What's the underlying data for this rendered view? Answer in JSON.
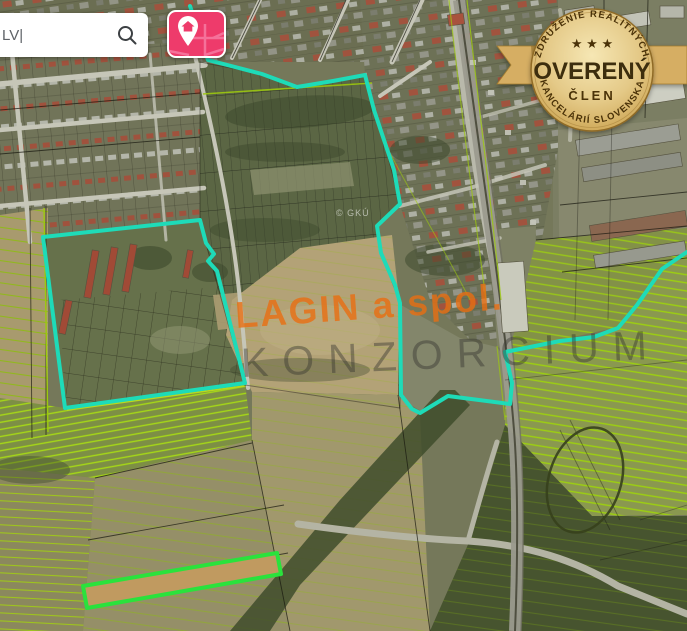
{
  "header": {
    "search": {
      "value": "LV|",
      "icon": "magnifier"
    }
  },
  "logo": {
    "icon": "map-pin-house",
    "color": "#EE3B6B"
  },
  "badge": {
    "arc_top": "ZDRUŽENIE REALITNÝCH",
    "stars": "★ ★ ★",
    "title": "OVERENÝ",
    "subtitle": "ČLEN",
    "arc_bottom": "KANCELÁRIÍ SLOVENSKA",
    "gold": "#D9B266"
  },
  "watermarks": {
    "company": "LAGIN a spol.",
    "consortium": "KONZORCIUM",
    "map_credit": "© GKÚ"
  },
  "map": {
    "type": "satellite-cadastral",
    "boundary_color": "#1EDBB8",
    "highlight_color": "#2AE23C",
    "parcel_line_color": "#9CC90E"
  }
}
